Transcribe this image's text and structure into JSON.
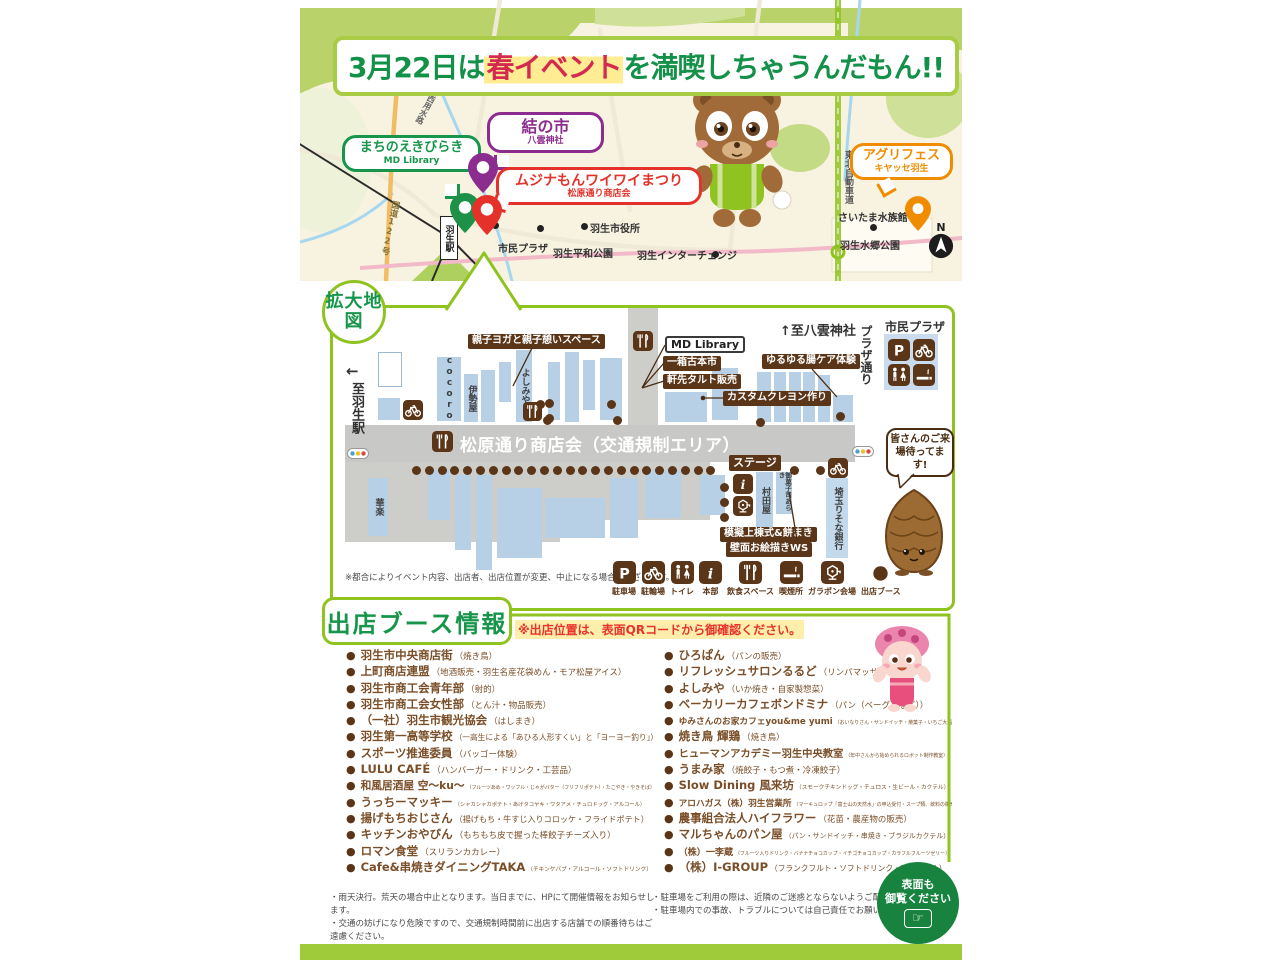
{
  "header": {
    "date_part": "3月22日は",
    "highlight": "春イベント",
    "tail_part": "を満喫しちゃうんだもん!!"
  },
  "top_map": {
    "bubbles": {
      "machinoeki": {
        "title": "まちのえきびらき",
        "subtitle": "MD Library"
      },
      "yuinoichi": {
        "title": "結の市",
        "subtitle": "八雲神社"
      },
      "mujinamon_fes": {
        "title": "ムジナもんワイワイまつり",
        "subtitle": "松原通り商店会"
      },
      "agrifes": {
        "title": "アグリフェス",
        "subtitle": "キヤッセ羽生"
      }
    },
    "places": {
      "shimin_plaza": "市民プラザ",
      "city_hall": "羽生市役所",
      "heiwa_park": "羽生平和公園",
      "interchange": "羽生インターチェンジ",
      "aquarium": "さいたま水族館",
      "suigo_park": "羽生水郷公園",
      "station": "羽生駅",
      "route122": "国道122号",
      "kasai_canal": "葛西用水路",
      "tohoku_expwy": "東北自動車道",
      "compass": "N"
    }
  },
  "detail_map": {
    "badge": "拡大地図",
    "to_station_arrow": "←",
    "to_station": "至羽生駅",
    "to_shrine": "↑至八雲神社",
    "plaza_street": "プラザ通り",
    "shimin_plaza": "市民プラザ",
    "street_label": "松原通り商店会（交通規制エリア）",
    "buildings": {
      "cocoro": "cocoro",
      "iseya": "伊勢屋",
      "yoshimiya": "よしみや",
      "karaku": "華楽",
      "murataya": "村田屋",
      "araki": "御菓子司あらき",
      "resona": "埼玉りそな銀行"
    },
    "events": {
      "yoga": "親子ヨガと親子憩いスペース",
      "md_library": "MD Library",
      "furuhon": "一箱古本市",
      "tart": "軒先タルト販売",
      "crayon": "カスタムクレヨン作り",
      "yuruyuru": "ゆるゆる腸ケア体験",
      "stage": "ステージ",
      "mogi": "模擬上棟式&餅まき",
      "hekimen": "壁面お絵描きWS"
    },
    "welcome": "皆さんのご来場待ってます!",
    "note": "※都合によりイベント内容、出店者、出店位置が変更、中止になる場合がございます。",
    "legend": [
      {
        "icon": "parking",
        "label": "駐車場"
      },
      {
        "icon": "bicycle",
        "label": "駐輪場"
      },
      {
        "icon": "toilet",
        "label": "トイレ"
      },
      {
        "icon": "info",
        "label": "本部"
      },
      {
        "icon": "food",
        "label": "飲食スペース"
      },
      {
        "icon": "smoking",
        "label": "喫煙所"
      },
      {
        "icon": "garapon",
        "label": "ガラポン会場"
      },
      {
        "icon": "booth-dot",
        "label": "出店ブース"
      }
    ]
  },
  "booths": {
    "heading": "出店ブース情報",
    "notice": "※出店位置は、表面QRコードから御確認ください。",
    "bullet": "●",
    "left": [
      {
        "name": "羽生市中央商店街",
        "note": "（焼き鳥）"
      },
      {
        "name": "上町商店連盟",
        "note": "（地酒販売・羽生名産花袋めん・モア松屋アイス）"
      },
      {
        "name": "羽生市商工会青年部",
        "note": "（射的）"
      },
      {
        "name": "羽生市商工会女性部",
        "note": "（とん汁・物品販売）"
      },
      {
        "name": "（一社）羽生市観光協会",
        "note": "（はしまき）"
      },
      {
        "name": "羽生第一高等学校",
        "note": "（一高生による「あひる人形すくい」と「ヨーヨー釣り」）"
      },
      {
        "name": "スポーツ推進委員",
        "note": "（バッゴー体験）"
      },
      {
        "name": "LULU CAFÉ",
        "note": "（ハンバーガー・ドリンク・工芸品）"
      },
      {
        "name": "和風居酒屋 空〜ku〜",
        "note": "（フルーツあめ・ワッフル・じゃがバター（フリフリポテト）・たこやき・やきそば）"
      },
      {
        "name": "うっちーマッキー",
        "note": "（シャカシャカポテト・あげタコヤキ・ワタアメ・チュロドッグ・アルコール）"
      },
      {
        "name": "揚げもちおじさん",
        "note": "（揚げもち・牛すじ入りコロッケ・フライドポテト）"
      },
      {
        "name": "キッチンおやびん",
        "note": "（もちもち皮で握った棒餃子チーズ入り）"
      },
      {
        "name": "ロマン食堂",
        "note": "（スリランカカレー）"
      },
      {
        "name": "Cafe&串焼きダイニングTAKA",
        "note": "（チキンケバブ・アルコール・ソフトドリンク）"
      }
    ],
    "right": [
      {
        "name": "ひろぱん",
        "note": "（パンの販売）"
      },
      {
        "name": "リフレッシュサロンるるど",
        "note": "（リンパマッサージ）"
      },
      {
        "name": "よしみや",
        "note": "（いか焼き・自家製惣菜）"
      },
      {
        "name": "ベーカリーカフェボンドミナ",
        "note": "（パン（ベーグルなど））"
      },
      {
        "name": "ゆみさんのお家カフェyou&me yumi",
        "note": "（おいなりさん・サンドイッチ・焼菓子・いちご大福・ハンバーガー・ピクルス）"
      },
      {
        "name": "焼き鳥 輝鶏",
        "note": "（焼き鳥）"
      },
      {
        "name": "ヒューマンアカデミー羽生中央教室",
        "note": "（年中さんから始められるロボット制作教室）"
      },
      {
        "name": "うまみ家",
        "note": "（焼餃子・もつ煮・冷凍餃子）"
      },
      {
        "name": "Slow Dining 風来坊",
        "note": "（スモークチキンドッグ・チュロス・生ビール・カクテル）"
      },
      {
        "name": "アロハガス（株）羽生営業所",
        "note": "（マーキュロップ「富士山の天然水」の申込受付・スープ類、飲料の販売）"
      },
      {
        "name": "農事組合法人ハイフラワー",
        "note": "（花苗・農産物の販売）"
      },
      {
        "name": "マルちゃんのパン屋",
        "note": "（パン・サンドイッチ・串焼き・ブラジルカクテル）"
      },
      {
        "name": "（株）一李蔵",
        "note": "（フルーツ入りドリンク・バナナチョコカップ・イチゴチョコカップ・カラフルフルーツゼリー）"
      },
      {
        "name": "（株）I-GROUP",
        "note": "（フランクフルト・ソフトドリンク・アルコール）"
      }
    ]
  },
  "footer": {
    "notes_left": [
      "・雨天決行。荒天の場合中止となります。当日までに、HPにて開催情報をお知らせします。",
      "・交通の妨げになり危険ですので、交通規制時間前に出店する店舗での順番待ちはご遠慮ください。",
      "・会場内は禁煙です。飲食スペース以外での飲食はご遠慮ください。"
    ],
    "notes_right": [
      "・駐車場をご利用の際は、近隣のご迷惑とならないようご配慮ください。",
      "・駐車場内での事故、トラブルについては自己責任でお願いいたします。"
    ],
    "badge_line1": "表面も",
    "badge_line2": "御覧ください",
    "badge_icon": "☞"
  },
  "colors": {
    "green": "#17964b",
    "yellow_green": "#8fc31f",
    "red": "#e4322b",
    "purple": "#8d2c8f",
    "orange": "#f08c00",
    "brown": "#5a3517"
  }
}
